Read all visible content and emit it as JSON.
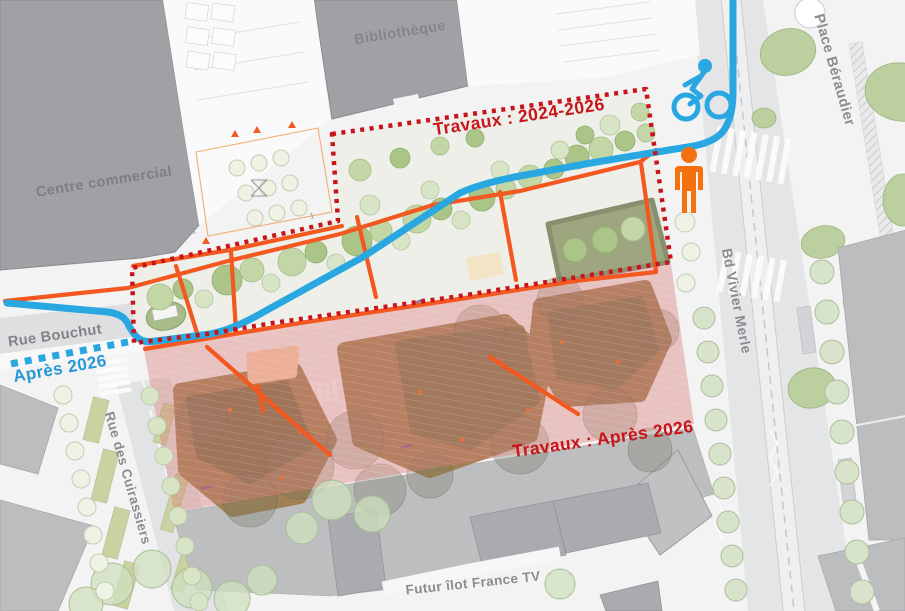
{
  "labels": {
    "library": "Bibliothèque",
    "shopping_center": "Centre commercial",
    "place_beraudier": "Place Béraudier",
    "bd_vivier_merle": "Bd Vivier Merle",
    "rue_bouchut": "Rue Bouchut",
    "rue_des_cuirassiers": "Rue des Cuirassiers",
    "futur_ilot_france_tv": "Futur îlot France TV",
    "parcel_mark": "1"
  },
  "annotations": {
    "works_2024_2026": "Travaux : 2024-2026",
    "works_after_2026": "Travaux : Après 2026",
    "after_2026": "Après 2026"
  },
  "legend_colors": {
    "bike_path_blue": "#29A7E1",
    "walk_path_orange": "#F2581F",
    "pedestrian_icon_orange": "#F4720E",
    "works_boundary_red": "#C8141A",
    "works_zone_pink": "#D97F78",
    "building_gray": "#9FA1A4",
    "tree_green": "#AAC587"
  },
  "icons": [
    "cyclist-icon",
    "pedestrian-icon"
  ]
}
